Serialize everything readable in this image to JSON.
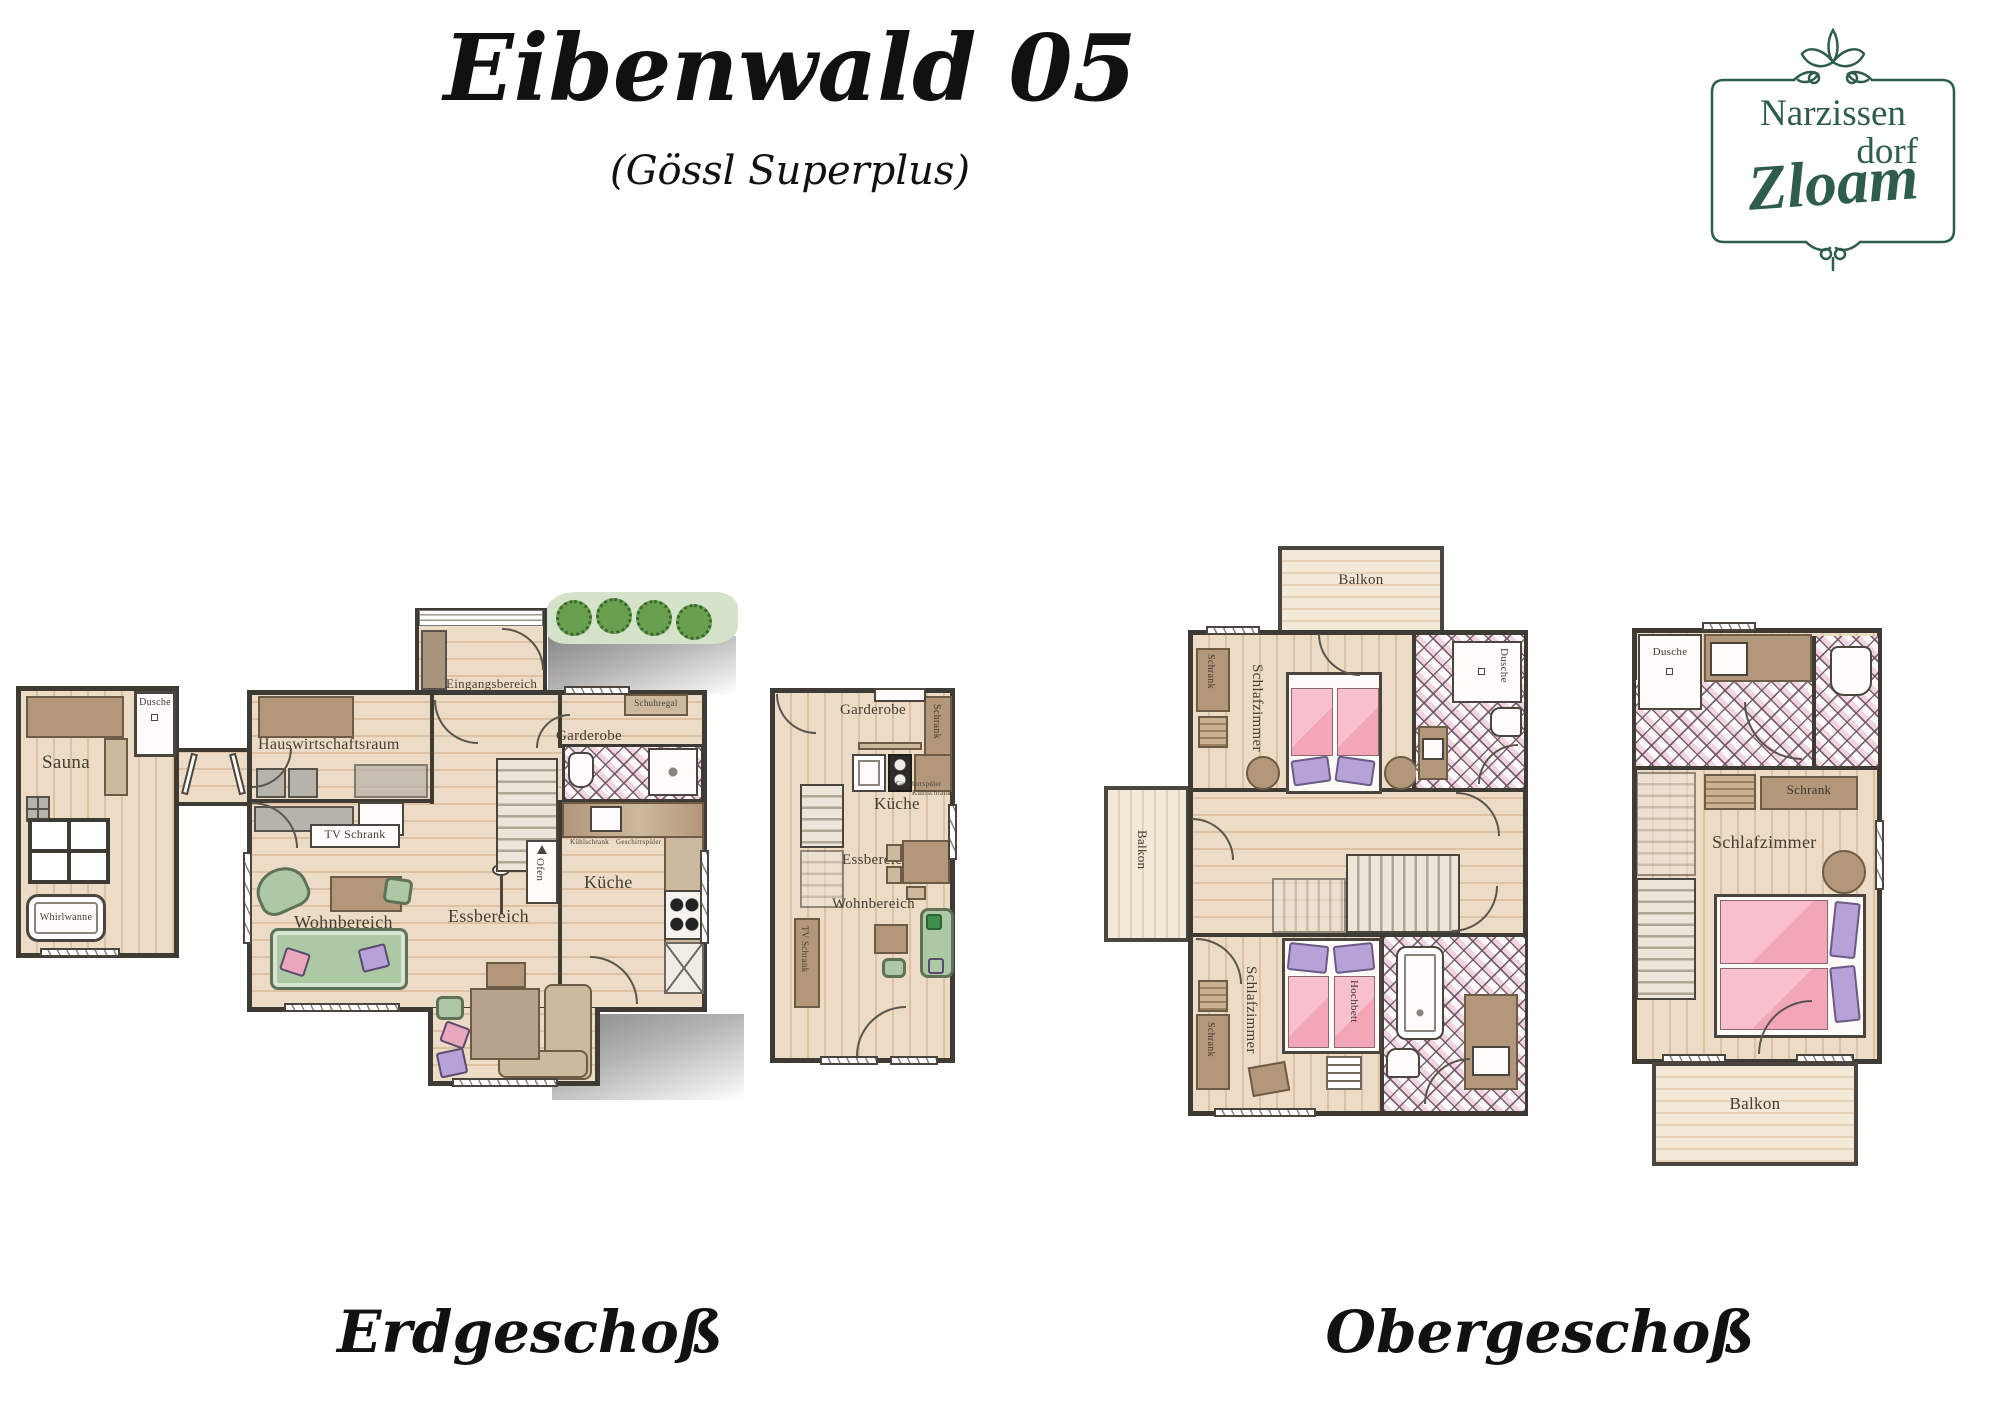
{
  "header": {
    "title": "Eibenwald 05",
    "subtitle": "(Gössl Superplus)"
  },
  "logo": {
    "line1": "Narzissen",
    "line2": "dorf",
    "line3": "Zloam"
  },
  "captions": {
    "ground": "Erdgeschoß",
    "upper": "Obergeschoß"
  },
  "labels": {
    "sauna": "Sauna",
    "dusche": "Dusche",
    "whirlwanne": "Whirlwanne",
    "eingangsbereich": "Eingangsbereich",
    "hauswirtschaftsraum": "Hauswirtschaftsraum",
    "garderobe": "Garderobe",
    "schuhregal": "Schuhregal",
    "tv_schrank": "TV Schrank",
    "wohnbereich": "Wohnbereich",
    "essbereich": "Essbereich",
    "kueche": "Küche",
    "ofen": "Ofen",
    "kuehlschrank": "Kühlschrank",
    "geschirrspueler": "Geschirrspüler",
    "schrank": "Schrank",
    "balkon": "Balkon",
    "schlafzimmer": "Schlafzimmer",
    "hochbett": "Hochbett"
  },
  "colors": {
    "logo_green": "#2e5d4b",
    "wall": "#3e3a34",
    "floor": "#ecdbc3",
    "plank_line": "#dcc2a2",
    "tile_pink": "#f0d4e0",
    "bed_pink": "#f3aebc",
    "pillow_purple": "#b7a2d8",
    "sofa_green": "#adc9a4",
    "wood_brown": "#b3977a",
    "hedge_green": "#69a04f",
    "shadow_gray": "#8c8c8c",
    "balcony_floor": "#f2e7d6"
  }
}
